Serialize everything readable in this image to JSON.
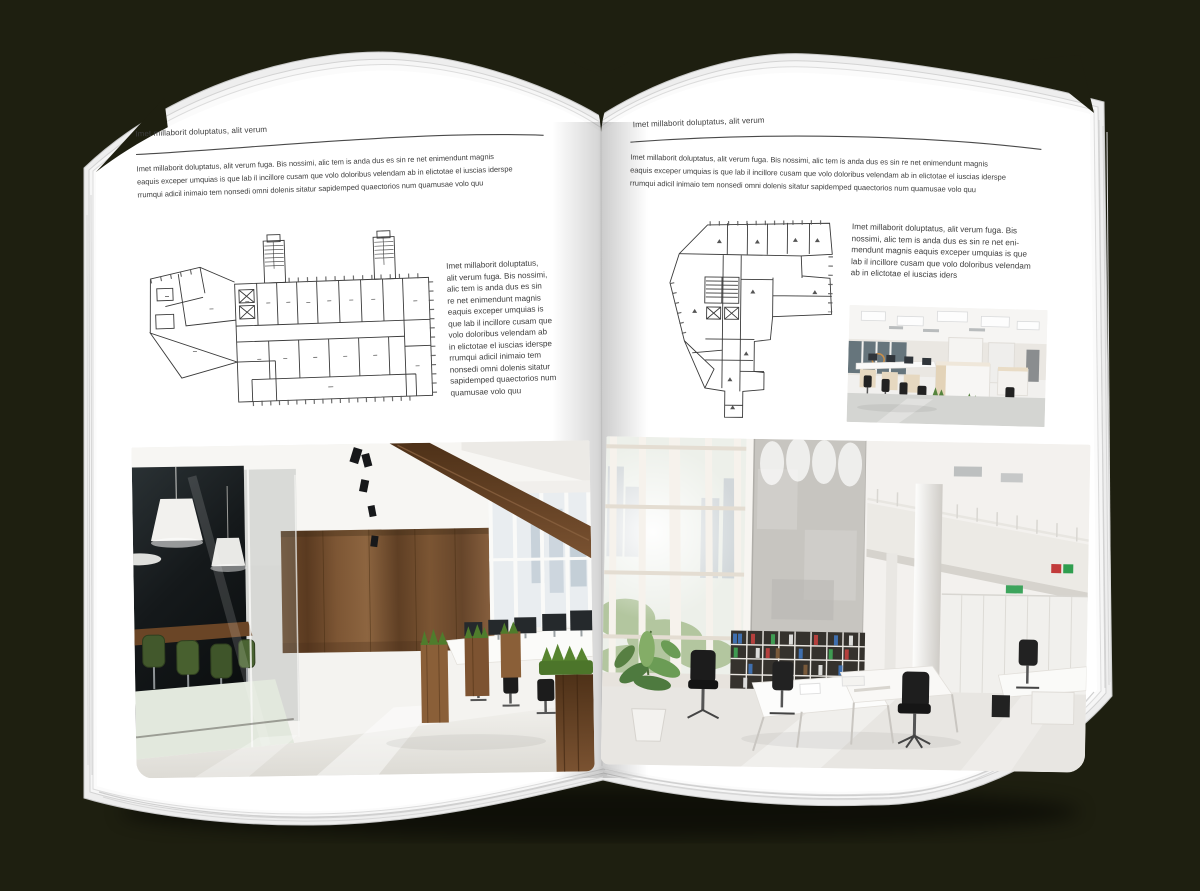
{
  "colors": {
    "background": "#1e1f10",
    "page": "#ffffff",
    "text": "#3d3d3d",
    "rule": "#4a4a4a",
    "wood": "#7a5233",
    "meeting_chair_green": "#45602f",
    "binder_blue": "#3f6fae",
    "binder_red": "#b5403d",
    "binder_green": "#3f9b52"
  },
  "left_page": {
    "header": "Imet millaborit doluptatus, alit verum",
    "intro_lines": [
      "Imet millaborit doluptatus, alit verum fuga. Bis nossimi, alic tem is anda dus es sin re net enimendunt magnis",
      "eaquis exceper umquias is que lab il incillore cusam que volo doloribus velendam ab in elictotae el iuscias iderspe",
      "rrumqui adicil inimaio tem nonsedi omni dolenis sitatur sapidemped quaectorios num quamusae volo quu"
    ],
    "sidebar_lines": [
      "Imet millaborit doluptatus,",
      "alit verum fuga. Bis nossimi,",
      "alic tem is anda dus es sin",
      "re net enimendunt magnis",
      "eaquis exceper umquias is",
      "que lab il incillore cusam que",
      "volo doloribus velendam ab",
      "in elictotae el iuscias iderspe",
      "rrumqui adicil inimaio tem",
      "nonsedi omni dolenis sitatur",
      "sapidemped quaectorios num",
      "quamusae volo quu"
    ],
    "floorplan_label": "floor plan - elongated slab building with two stair towers",
    "photo_label": "loft office interior: dark glass meeting room with green chairs, wood panel wall, desks by windows"
  },
  "right_page": {
    "header": "Imet millaborit doluptatus, alit verum",
    "intro_lines": [
      "Imet millaborit doluptatus, alit verum fuga. Bis nossimi, alic tem is anda dus es sin re net enimendunt magnis",
      "eaquis exceper umquias is que lab il incillore cusam que volo doloribus velendam ab in elictotae el iuscias iderspe",
      "rrumqui adicil inimaio tem nonsedi omni dolenis sitatur sapidemped quaectorios num quamusae volo quu"
    ],
    "body_lines": [
      "Imet millaborit doluptatus, alit verum fuga. Bis",
      "nossimi, alic tem is anda dus es sin re net eni-",
      "mendunt magnis eaquis exceper umquias is que",
      "lab il incillore cusam que volo doloribus velendam",
      "ab in elictotae el iuscias iders"
    ],
    "floorplan_label": "floor plan - irregular corner building with bottom wing",
    "photo_small_label": "open-plan office with rows of white desks and black chairs",
    "photo_large_label": "double-height white office atrium with glass facade, concrete wall, binder shelves and desks"
  }
}
